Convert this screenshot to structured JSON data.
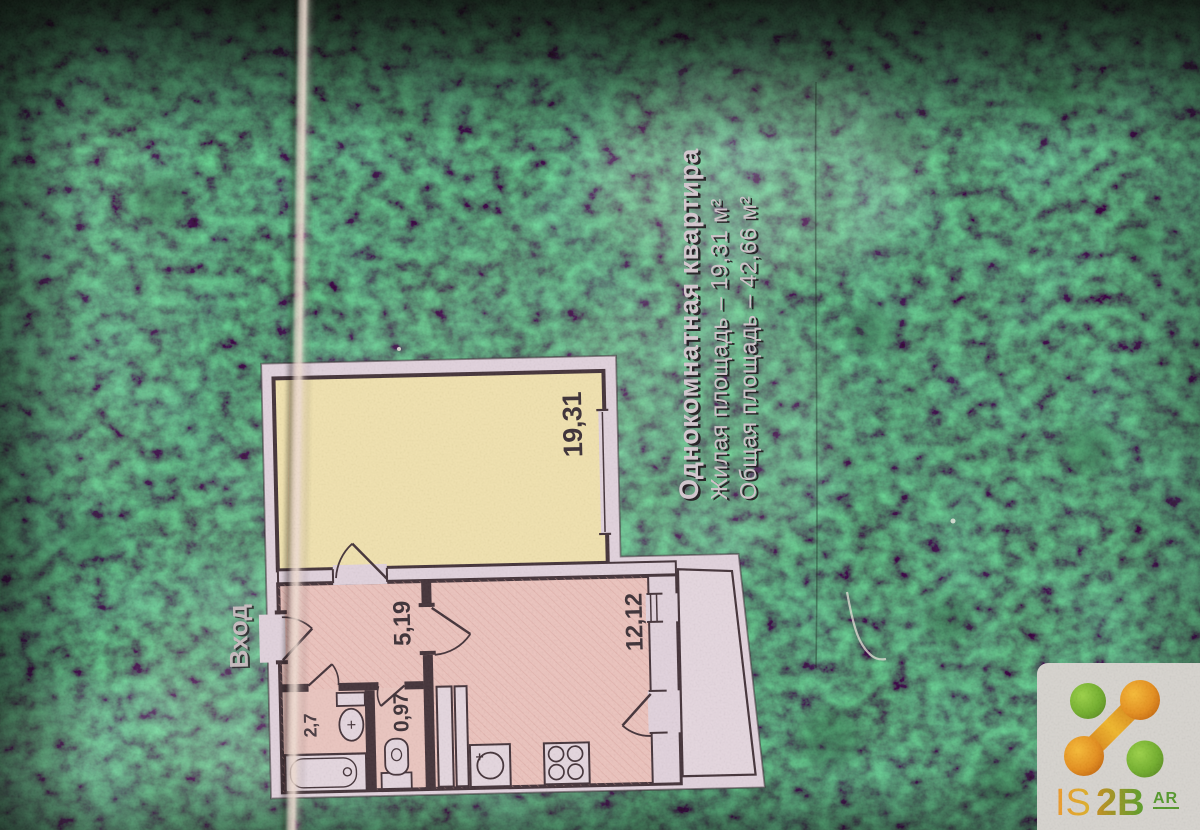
{
  "info_panel": {
    "title": "Однокомнатная квартира",
    "living_area_line": "Жилая площадь – 19,31 м²",
    "total_area_line": "Общая площадь – 42,66 м²"
  },
  "floor_plan": {
    "entrance_label": "Вход",
    "rooms": {
      "living_room": "19,31",
      "hallway": "5,19",
      "kitchen": "12,12",
      "wc": "0,97",
      "bathroom": "2,7"
    }
  },
  "watermark": {
    "text_is": "IS",
    "text_2b": "2B",
    "badge": "AR"
  },
  "colors": {
    "background_green": "#17251b",
    "plan_paper": "#e3d4de",
    "living_room_fill": "#f2e3b0",
    "rooms_fill": "#edc5bf",
    "wall": "#46353b",
    "label_text": "#3f3339",
    "info_text": "#d6cad1",
    "logo_green": "#6fae2c",
    "logo_orange": "#e08a1a",
    "card_fill": "#d8d5d0"
  }
}
